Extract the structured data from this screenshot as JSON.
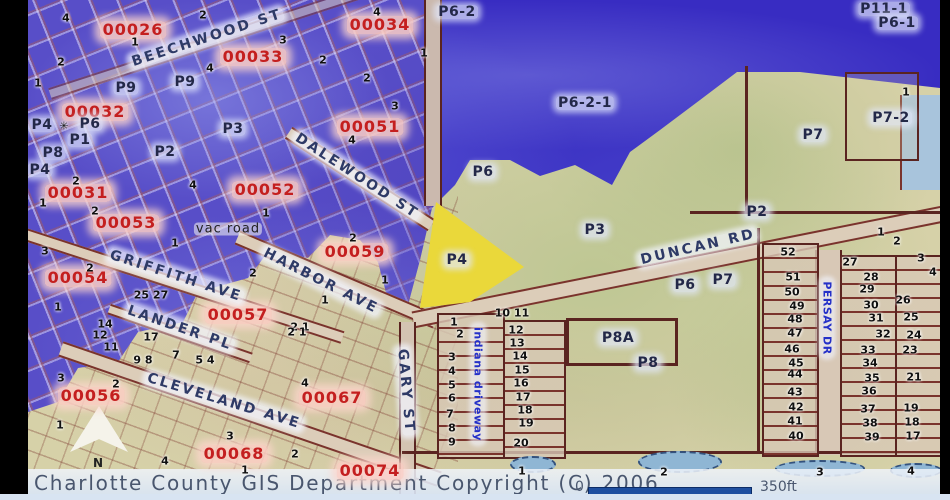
{
  "window": {
    "copyright": "Charlotte County GIS Department Copyright (C) 2006",
    "scale": {
      "zero": "0",
      "length_label": "350ft"
    },
    "north_label": "N"
  },
  "colors": {
    "water": "#382cc2",
    "zone_purple": "#584ec8",
    "land_tan": "#d6d1a8",
    "land_green": "#aabe82",
    "highlight_parcel": "#ead83a",
    "road_line": "#7a332c",
    "parcel_id_red": "#c41f1f",
    "zone_label_navy": "#232848",
    "street_navy": "#2e3a66",
    "street_blue": "#2430c8",
    "scalebar_blue": "#1e4fa0"
  },
  "labels": {
    "parcels": [
      {
        "t": "00026",
        "x": 133,
        "y": 30
      },
      {
        "t": "00034",
        "x": 380,
        "y": 25
      },
      {
        "t": "00033",
        "x": 253,
        "y": 57
      },
      {
        "t": "00032",
        "x": 95,
        "y": 112
      },
      {
        "t": "00051",
        "x": 370,
        "y": 127
      },
      {
        "t": "00031",
        "x": 78,
        "y": 193
      },
      {
        "t": "00052",
        "x": 265,
        "y": 190
      },
      {
        "t": "00053",
        "x": 126,
        "y": 223
      },
      {
        "t": "00059",
        "x": 355,
        "y": 252
      },
      {
        "t": "00054",
        "x": 78,
        "y": 278
      },
      {
        "t": "00057",
        "x": 238,
        "y": 315
      },
      {
        "t": "00056",
        "x": 91,
        "y": 396
      },
      {
        "t": "00067",
        "x": 332,
        "y": 398
      },
      {
        "t": "00068",
        "x": 234,
        "y": 454
      },
      {
        "t": "00074",
        "x": 370,
        "y": 471
      }
    ],
    "zones": [
      {
        "t": "P9",
        "x": 126,
        "y": 88
      },
      {
        "t": "P9",
        "x": 185,
        "y": 82
      },
      {
        "t": "P6-2",
        "x": 457,
        "y": 12
      },
      {
        "t": "P11-1",
        "x": 884,
        "y": 9
      },
      {
        "t": "P6-1",
        "x": 897,
        "y": 23
      },
      {
        "t": "P6-2-1",
        "x": 585,
        "y": 103
      },
      {
        "t": "P7",
        "x": 813,
        "y": 135
      },
      {
        "t": "P7-2",
        "x": 891,
        "y": 118
      },
      {
        "t": "P3",
        "x": 233,
        "y": 129
      },
      {
        "t": "P4",
        "x": 42,
        "y": 125
      },
      {
        "t": "P6",
        "x": 90,
        "y": 124
      },
      {
        "t": "P1",
        "x": 80,
        "y": 140
      },
      {
        "t": "P8",
        "x": 53,
        "y": 153
      },
      {
        "t": "P2",
        "x": 165,
        "y": 152
      },
      {
        "t": "P4",
        "x": 40,
        "y": 170
      },
      {
        "t": "P6",
        "x": 483,
        "y": 172
      },
      {
        "t": "P4",
        "x": 457,
        "y": 260
      },
      {
        "t": "P3",
        "x": 595,
        "y": 230
      },
      {
        "t": "P2",
        "x": 757,
        "y": 212
      },
      {
        "t": "P6",
        "x": 685,
        "y": 285
      },
      {
        "t": "P7",
        "x": 723,
        "y": 280
      },
      {
        "t": "P8A",
        "x": 618,
        "y": 338
      },
      {
        "t": "P8",
        "x": 648,
        "y": 363
      }
    ],
    "streets": [
      {
        "t": "BEECHWOOD ST",
        "x": 207,
        "y": 38,
        "r": -18
      },
      {
        "t": "DALEWOOD ST",
        "x": 357,
        "y": 176,
        "r": 33
      },
      {
        "t": "HARBOR AVE",
        "x": 321,
        "y": 281,
        "r": 27
      },
      {
        "t": "GRIFFITH AVE",
        "x": 176,
        "y": 276,
        "r": 18
      },
      {
        "t": "LANDER PL",
        "x": 180,
        "y": 328,
        "r": 19
      },
      {
        "t": "CLEVELAND AVE",
        "x": 224,
        "y": 401,
        "r": 17
      },
      {
        "t": "GARY ST",
        "x": 406,
        "y": 391,
        "r": 85
      },
      {
        "t": "DUNCAN RD",
        "x": 698,
        "y": 247,
        "r": -13
      },
      {
        "t": "indiana driveway",
        "x": 478,
        "y": 384,
        "r": 90,
        "k": "blue"
      },
      {
        "t": "PERSAY DR",
        "x": 827,
        "y": 318,
        "r": 90,
        "k": "blue"
      },
      {
        "t": "vac road",
        "x": 228,
        "y": 229,
        "r": 0,
        "k": "plain"
      }
    ],
    "lots": [
      {
        "t": "4",
        "x": 66,
        "y": 18
      },
      {
        "t": "2",
        "x": 203,
        "y": 15
      },
      {
        "t": "4",
        "x": 377,
        "y": 12
      },
      {
        "t": "1",
        "x": 135,
        "y": 42
      },
      {
        "t": "3",
        "x": 283,
        "y": 40
      },
      {
        "t": "2",
        "x": 61,
        "y": 62
      },
      {
        "t": "4",
        "x": 210,
        "y": 68
      },
      {
        "t": "2",
        "x": 323,
        "y": 60
      },
      {
        "t": "2",
        "x": 367,
        "y": 78
      },
      {
        "t": "1",
        "x": 424,
        "y": 53
      },
      {
        "t": "1",
        "x": 38,
        "y": 83
      },
      {
        "t": "3",
        "x": 395,
        "y": 106
      },
      {
        "t": "4",
        "x": 352,
        "y": 140
      },
      {
        "t": "✳",
        "x": 64,
        "y": 126
      },
      {
        "t": "2",
        "x": 76,
        "y": 181
      },
      {
        "t": "4",
        "x": 193,
        "y": 185
      },
      {
        "t": "1",
        "x": 43,
        "y": 203
      },
      {
        "t": "2",
        "x": 95,
        "y": 211
      },
      {
        "t": "1",
        "x": 266,
        "y": 213
      },
      {
        "t": "3",
        "x": 45,
        "y": 251
      },
      {
        "t": "2",
        "x": 90,
        "y": 268
      },
      {
        "t": "1",
        "x": 175,
        "y": 243
      },
      {
        "t": "2",
        "x": 353,
        "y": 238
      },
      {
        "t": "2",
        "x": 253,
        "y": 273
      },
      {
        "t": "1",
        "x": 385,
        "y": 280
      },
      {
        "t": "1",
        "x": 325,
        "y": 300
      },
      {
        "t": "2 1",
        "x": 300,
        "y": 327
      },
      {
        "t": "25 27",
        "x": 151,
        "y": 295
      },
      {
        "t": "1",
        "x": 58,
        "y": 307
      },
      {
        "t": "14",
        "x": 105,
        "y": 324
      },
      {
        "t": "12",
        "x": 100,
        "y": 335
      },
      {
        "t": "17",
        "x": 151,
        "y": 337
      },
      {
        "t": "11",
        "x": 111,
        "y": 347
      },
      {
        "t": "9 8",
        "x": 143,
        "y": 360
      },
      {
        "t": "7",
        "x": 176,
        "y": 355
      },
      {
        "t": "5 4",
        "x": 205,
        "y": 360
      },
      {
        "t": "2 1",
        "x": 297,
        "y": 332
      },
      {
        "t": "3",
        "x": 61,
        "y": 378
      },
      {
        "t": "2",
        "x": 116,
        "y": 384
      },
      {
        "t": "4",
        "x": 305,
        "y": 383
      },
      {
        "t": "1",
        "x": 60,
        "y": 425
      },
      {
        "t": "3",
        "x": 230,
        "y": 436
      },
      {
        "t": "4",
        "x": 165,
        "y": 461
      },
      {
        "t": "2",
        "x": 295,
        "y": 454
      },
      {
        "t": "1",
        "x": 245,
        "y": 470
      },
      {
        "t": "1",
        "x": 454,
        "y": 322
      },
      {
        "t": "2",
        "x": 460,
        "y": 334
      },
      {
        "t": "3",
        "x": 452,
        "y": 357
      },
      {
        "t": "4",
        "x": 452,
        "y": 371
      },
      {
        "t": "5",
        "x": 452,
        "y": 385
      },
      {
        "t": "6",
        "x": 452,
        "y": 398
      },
      {
        "t": "7",
        "x": 450,
        "y": 414
      },
      {
        "t": "8",
        "x": 452,
        "y": 428
      },
      {
        "t": "9",
        "x": 452,
        "y": 442
      },
      {
        "t": "10 11",
        "x": 512,
        "y": 313
      },
      {
        "t": "12",
        "x": 516,
        "y": 330
      },
      {
        "t": "13",
        "x": 517,
        "y": 343
      },
      {
        "t": "14",
        "x": 520,
        "y": 356
      },
      {
        "t": "15",
        "x": 522,
        "y": 370
      },
      {
        "t": "16",
        "x": 521,
        "y": 383
      },
      {
        "t": "17",
        "x": 523,
        "y": 397
      },
      {
        "t": "18",
        "x": 525,
        "y": 410
      },
      {
        "t": "19",
        "x": 526,
        "y": 423
      },
      {
        "t": "20",
        "x": 521,
        "y": 443
      },
      {
        "t": "52",
        "x": 788,
        "y": 252
      },
      {
        "t": "51",
        "x": 793,
        "y": 277
      },
      {
        "t": "50",
        "x": 792,
        "y": 292
      },
      {
        "t": "49",
        "x": 797,
        "y": 306
      },
      {
        "t": "48",
        "x": 795,
        "y": 319
      },
      {
        "t": "47",
        "x": 795,
        "y": 333
      },
      {
        "t": "46",
        "x": 792,
        "y": 349
      },
      {
        "t": "45",
        "x": 796,
        "y": 363
      },
      {
        "t": "44",
        "x": 795,
        "y": 374
      },
      {
        "t": "43",
        "x": 795,
        "y": 392
      },
      {
        "t": "42",
        "x": 796,
        "y": 407
      },
      {
        "t": "41",
        "x": 795,
        "y": 421
      },
      {
        "t": "40",
        "x": 796,
        "y": 436
      },
      {
        "t": "1",
        "x": 881,
        "y": 232
      },
      {
        "t": "2",
        "x": 897,
        "y": 241
      },
      {
        "t": "3",
        "x": 921,
        "y": 258
      },
      {
        "t": "4",
        "x": 933,
        "y": 272
      },
      {
        "t": "27",
        "x": 850,
        "y": 262
      },
      {
        "t": "28",
        "x": 871,
        "y": 277
      },
      {
        "t": "29",
        "x": 867,
        "y": 289
      },
      {
        "t": "30",
        "x": 871,
        "y": 305
      },
      {
        "t": "26",
        "x": 903,
        "y": 300
      },
      {
        "t": "31",
        "x": 876,
        "y": 318
      },
      {
        "t": "25",
        "x": 911,
        "y": 317
      },
      {
        "t": "32",
        "x": 883,
        "y": 334
      },
      {
        "t": "24",
        "x": 914,
        "y": 335
      },
      {
        "t": "33",
        "x": 868,
        "y": 350
      },
      {
        "t": "23",
        "x": 910,
        "y": 350
      },
      {
        "t": "34",
        "x": 870,
        "y": 363
      },
      {
        "t": "35",
        "x": 872,
        "y": 378
      },
      {
        "t": "21",
        "x": 914,
        "y": 377
      },
      {
        "t": "36",
        "x": 869,
        "y": 391
      },
      {
        "t": "37",
        "x": 868,
        "y": 409
      },
      {
        "t": "19",
        "x": 911,
        "y": 408
      },
      {
        "t": "38",
        "x": 870,
        "y": 423
      },
      {
        "t": "18",
        "x": 912,
        "y": 422
      },
      {
        "t": "39",
        "x": 872,
        "y": 437
      },
      {
        "t": "17",
        "x": 913,
        "y": 436
      },
      {
        "t": "1",
        "x": 906,
        "y": 92
      },
      {
        "t": "1",
        "x": 522,
        "y": 471
      },
      {
        "t": "2",
        "x": 664,
        "y": 472
      },
      {
        "t": "3",
        "x": 820,
        "y": 472
      },
      {
        "t": "4",
        "x": 911,
        "y": 471
      }
    ]
  },
  "ponds": [
    {
      "x": 533,
      "y": 464,
      "w": 46,
      "h": 17
    },
    {
      "x": 680,
      "y": 462,
      "w": 84,
      "h": 22
    },
    {
      "x": 820,
      "y": 468,
      "w": 90,
      "h": 17
    },
    {
      "x": 916,
      "y": 470,
      "w": 52,
      "h": 15
    }
  ]
}
